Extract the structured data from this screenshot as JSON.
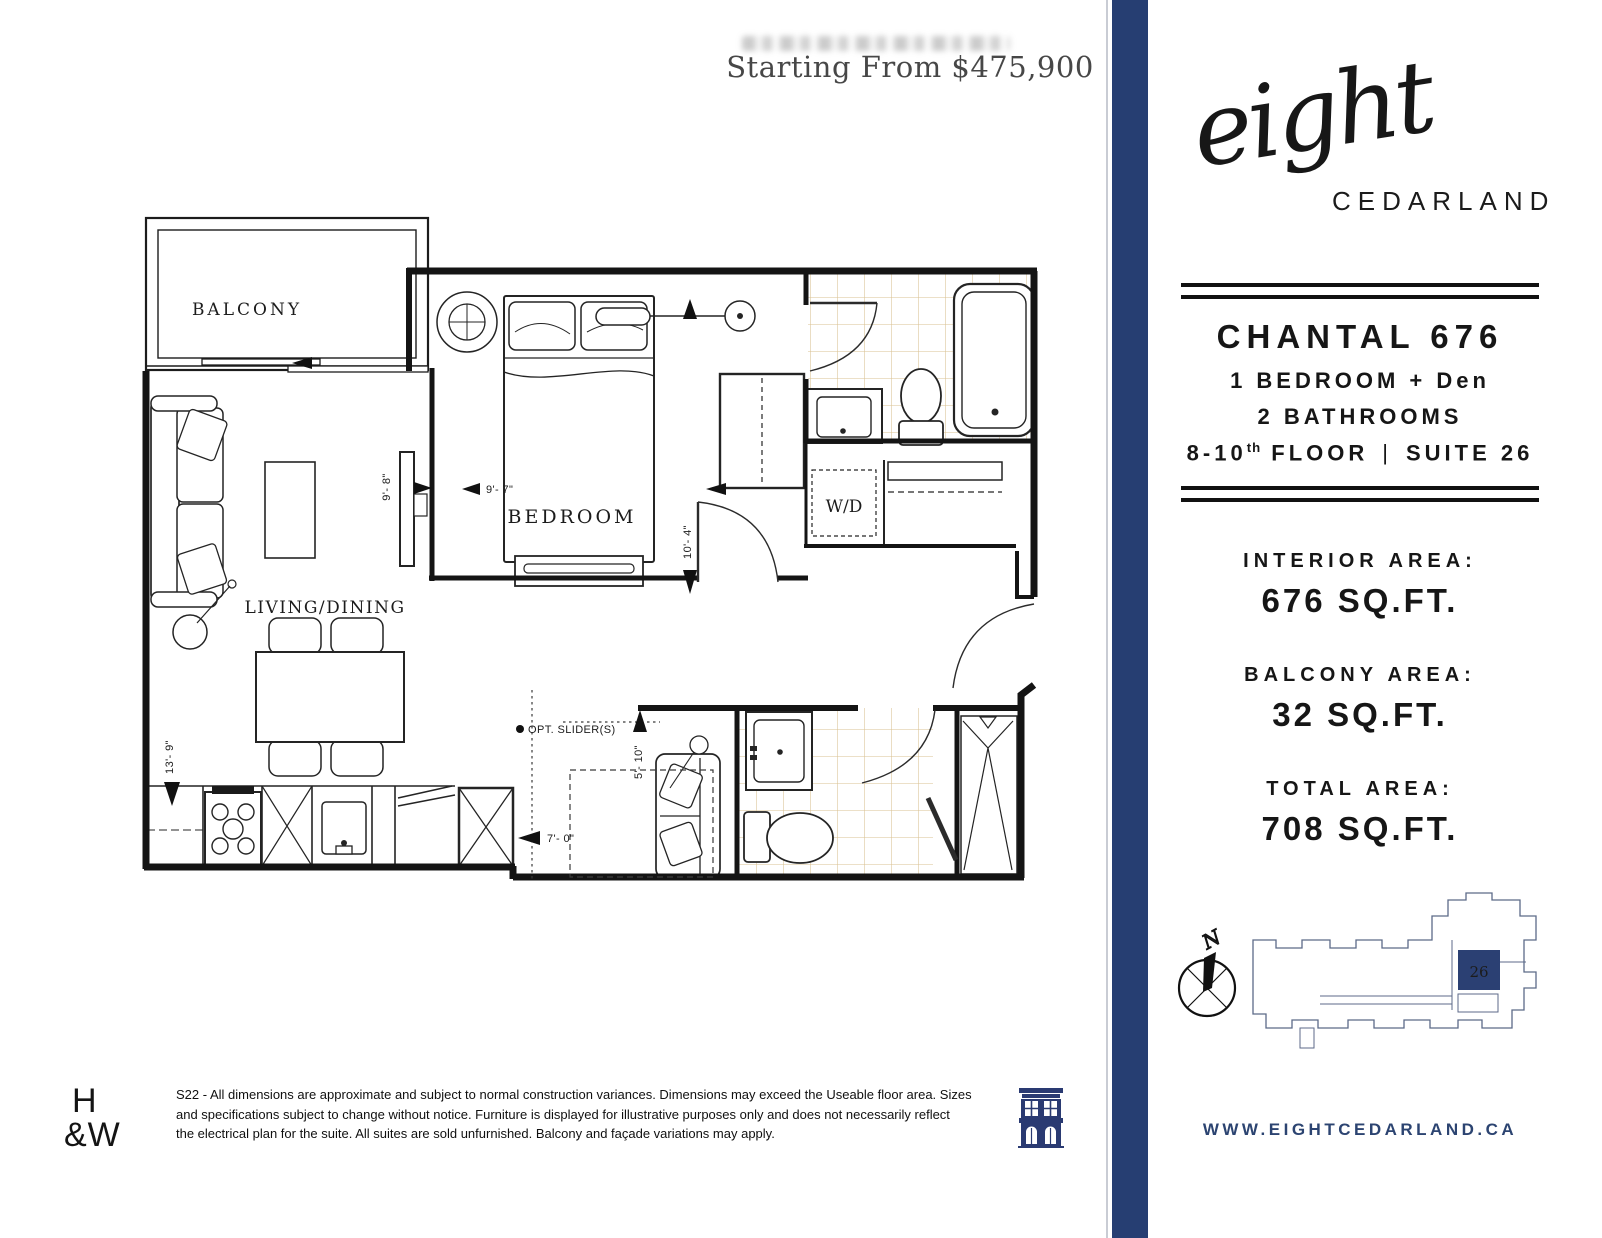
{
  "header": {
    "price": "Starting From $475,900"
  },
  "brand": {
    "logo_script": "eight",
    "logo_caps": "CEDARLAND",
    "website": "WWW.EIGHTCEDARLAND.CA"
  },
  "unit": {
    "name": "CHANTAL 676",
    "bedrooms": "1 BEDROOM + Den",
    "bathrooms": "2 BATHROOMS",
    "floor_main": "8-10",
    "floor_sup": "th",
    "floor_rest": " FLOOR",
    "pipe": "|",
    "suite": "SUITE 26"
  },
  "areas": [
    {
      "label": "INTERIOR AREA:",
      "value": "676 SQ.FT."
    },
    {
      "label": "BALCONY AREA:",
      "value": "32 SQ.FT."
    },
    {
      "label": "TOTAL AREA:",
      "value": "708 SQ.FT."
    }
  ],
  "keyplan": {
    "unit_number": "26",
    "compass_label": "N"
  },
  "floorplan": {
    "rooms": {
      "balcony": "BALCONY",
      "bedroom": "BEDROOM",
      "living": "LIVING/DINING",
      "wd": "W/D"
    },
    "dimensions": {
      "tv_wall": "9'- 8\"",
      "bedroom_width": "9'- 7\"",
      "bedroom_depth": "10'- 4\"",
      "living_depth": "13'- 9\"",
      "den_depth": "5'- 10\"",
      "den_width": "7'- 0\"",
      "opt_slider": "OPT. SLIDER(S)"
    }
  },
  "footer": {
    "logo_line1": "H",
    "logo_line2": "&W",
    "disclaimer_lines": [
      "S22 - All dimensions are approximate and subject to normal construction variances. Dimensions may exceed the Useable floor area. Sizes",
      "and specifications subject to change without notice. Furniture is displayed for illustrative purposes only and does not necessarily reflect",
      "the electrical plan for the suite. All suites are sold unfurnished. Balcony and façade variations may apply."
    ]
  },
  "colors": {
    "navy": "#263e72",
    "tile": "#d9c191"
  }
}
